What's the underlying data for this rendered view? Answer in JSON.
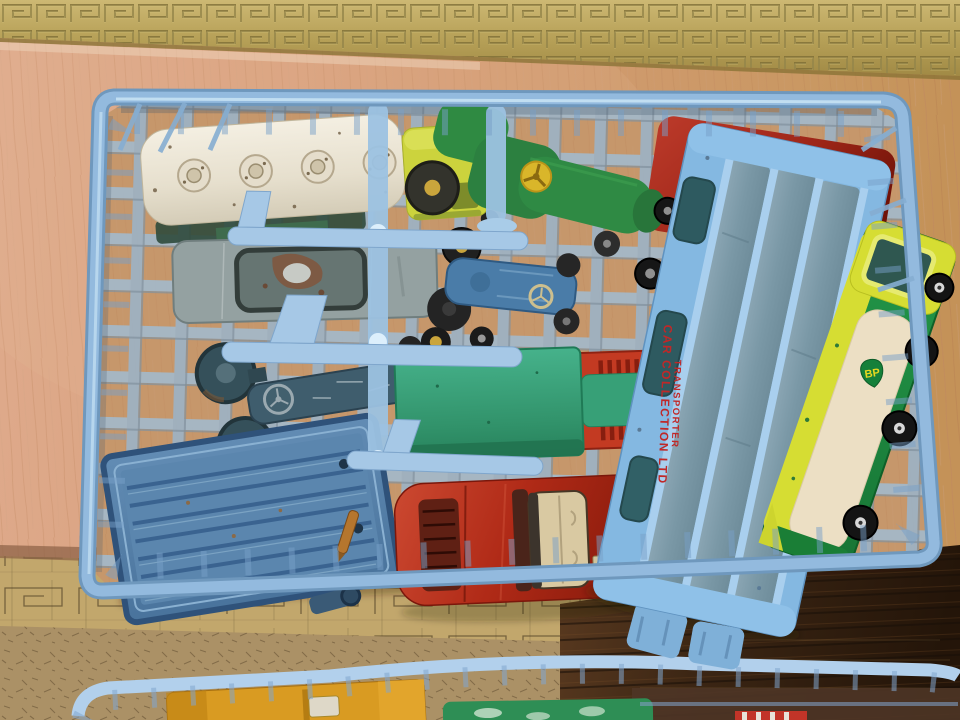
{
  "photo": {
    "description": "Vintage diecast toy vehicles stored in a light blue plastic dealer crate sitting on a wooden table with brass Greek-key inlay bands; a second crate of toys is partly visible along the bottom edge.",
    "texts": {
      "transporter_line1": "CAR COLLECTION LTD",
      "transporter_line2": "TRANSPORTER",
      "bp_logo": "BP"
    },
    "palette": {
      "crate_blue": "#8fb7da",
      "crate_blue_light": "#b9d8ee",
      "brass_band": "#b9a55e",
      "wood_pink": "#d9a183",
      "wood_gold": "#c89a63",
      "wood_dark": "#36220f",
      "transporter_text_red": "#c02828",
      "bp_green": "#15803a",
      "bp_yellow": "#e8d820"
    },
    "vehicles": [
      {
        "name": "fuel-tanker-truck",
        "tank": "#e9e3d5",
        "cab": "#ccd33d"
      },
      {
        "name": "green-tractor",
        "body": "#2f8a42",
        "steering_wheel": "#d9b62a"
      },
      {
        "name": "red-coach",
        "body": "#a5281e"
      },
      {
        "name": "grey-saloon-car",
        "body": "#94a1a1",
        "wear_patch": "#7d5a44"
      },
      {
        "name": "blue-tractor-small",
        "body": "#4a7ca8"
      },
      {
        "name": "blue-tractor-large",
        "body": "#3f5d6d"
      },
      {
        "name": "teal-box-truck",
        "container": "#3aa57c",
        "cab": "#c33a22"
      },
      {
        "name": "blue-tipping-trailer",
        "body": "#4f7da8"
      },
      {
        "name": "red-sports-car",
        "body": "#b5301f",
        "interior": "#d9c9a2"
      },
      {
        "name": "car-transporter",
        "frame": "#84b8e1",
        "decks": "#7e9aa8"
      },
      {
        "name": "bp-petrol-tanker",
        "body": "#1e8c3e",
        "stripe": "#d6dd33",
        "tank": "#ecdfc4"
      },
      {
        "name": "yellow-truck-bottom-crate",
        "body": "#d99b22"
      },
      {
        "name": "green-vehicle-bottom-crate",
        "body": "#2e8e55"
      }
    ]
  }
}
